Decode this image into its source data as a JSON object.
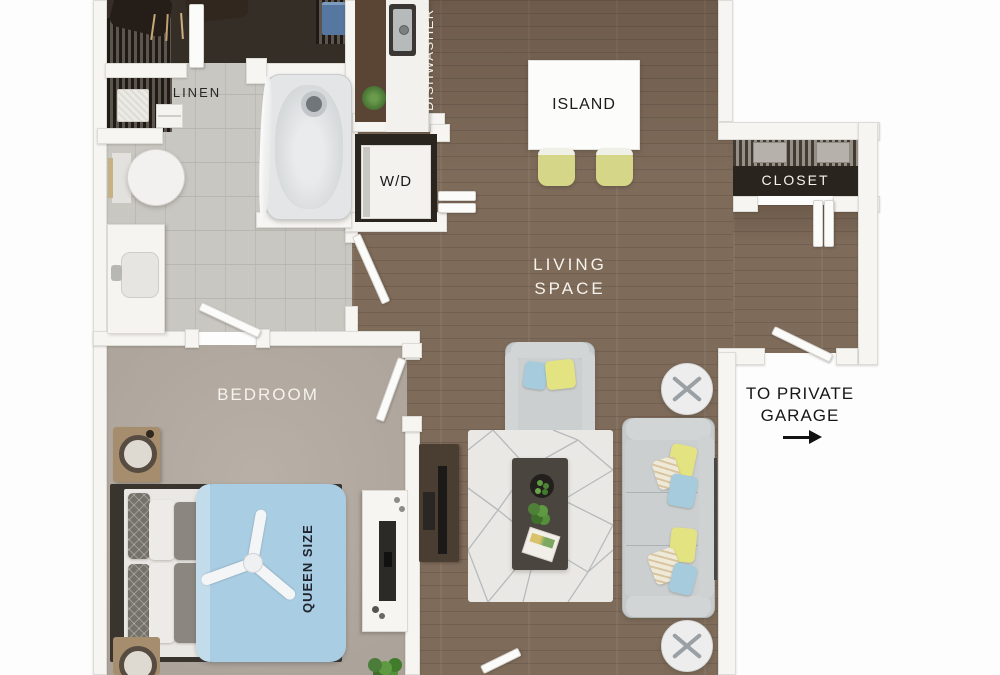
{
  "page": {
    "kind": "3D apartment floor plan rendering",
    "background": "#ffffff"
  },
  "labels": {
    "linen": "LINEN",
    "dishwasher": "DISHWASHER",
    "island": "ISLAND",
    "washer_dryer": "W/D",
    "closet": "CLOSET",
    "living_line1": "LIVING",
    "living_line2": "SPACE",
    "bedroom": "BEDROOM",
    "queen_size": "QUEEN SIZE",
    "garage_line1": "TO PRIVATE",
    "garage_line2": "GARAGE"
  },
  "icons": {
    "garage_arrow": "right-arrow",
    "bed_fan": "ceiling-fan"
  },
  "colors": {
    "wood_floor": "#7e6b5a",
    "bedroom_carpet": "#b3aaa0",
    "bathroom_tile": "#c9c7c2",
    "wall_white": "#f6f5f2",
    "closet_dark": "#2a241f",
    "stool_yellow": "#d5d687",
    "pillow_yellow": "#e4e382",
    "pillow_blue": "#a5cbdd",
    "duvet_blue": "#a9cde2",
    "sofa_gray": "#c6cacb",
    "label_light": "#f6f3ed",
    "label_dark": "#1b1b1c"
  }
}
